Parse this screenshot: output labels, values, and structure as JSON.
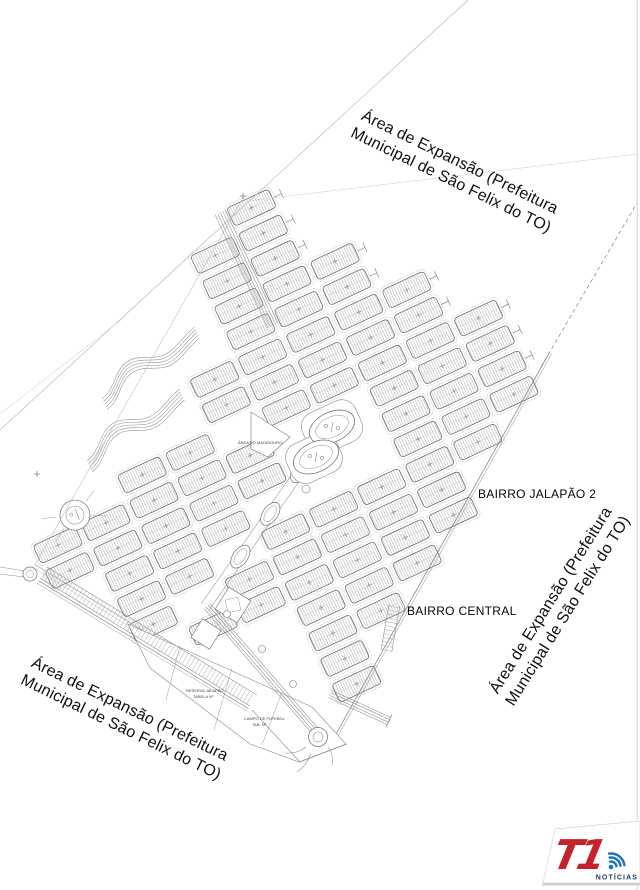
{
  "map": {
    "expansion_label_line1": "Área de Expansão (Prefeitura",
    "expansion_label_line2": "Municipal de São Felix do TO)",
    "bairro_jalapao_label": "BAIRRO JALAPÃO 2",
    "bairro_central_label": "BAIRRO CENTRAL",
    "tiny_labels": {
      "matadouro": "ÁREA DO MATADOURO",
      "reserva_line1": "RESERVA JALAPÃO",
      "reserva_line2": "TABELA Nº",
      "campo_line1": "CAMPO DE FUTEBOL",
      "campo_line2": "TAB. Nº"
    },
    "colors": {
      "block_stroke": "#5f5f5f",
      "curb_stroke": "#d2d2d2",
      "hatch": "#a8a8a8",
      "road": "#8f8f8f",
      "boundary": "#777777"
    }
  },
  "logo": {
    "brand": "T1",
    "tagline": "NOTÍCIAS",
    "red": "#c5232b",
    "blue": "#1e73be",
    "navy": "#16395f"
  }
}
